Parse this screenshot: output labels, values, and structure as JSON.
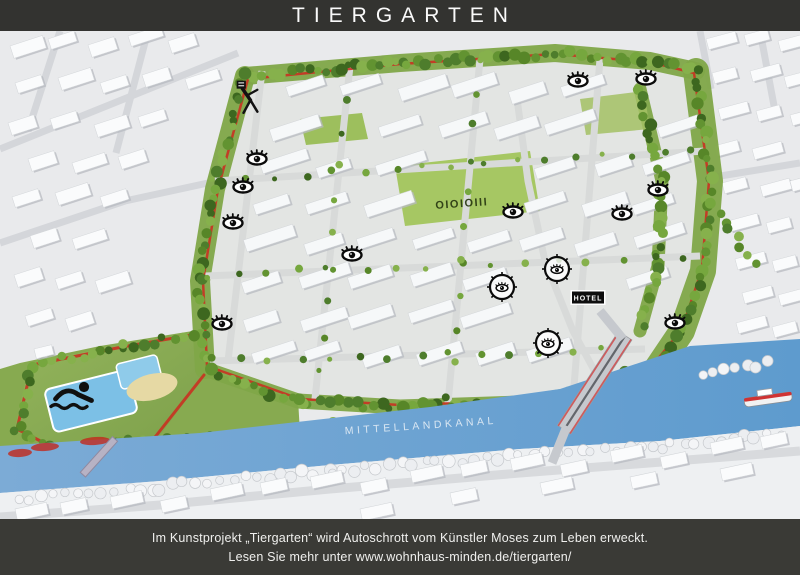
{
  "header": {
    "title": "TIERGARTEN"
  },
  "map": {
    "canal_label": "MITTELLANDKANAL",
    "hotel_label": "HOTEL",
    "lawn_text": "OIOIOIII",
    "colors": {
      "canal_blue": "#6aa3d6",
      "park_green": "#7fa648",
      "track_red": "#cc2a1e",
      "building_white": "#f8fafb",
      "bar_dark": "#333330"
    },
    "markers": {
      "eyes": [
        [
          257,
          128
        ],
        [
          243,
          156
        ],
        [
          233,
          192
        ],
        [
          352,
          224
        ],
        [
          513,
          181
        ],
        [
          578,
          50
        ],
        [
          646,
          48
        ],
        [
          658,
          159
        ],
        [
          622,
          183
        ],
        [
          675,
          292
        ],
        [
          222,
          293
        ]
      ],
      "circled_eyes": [
        [
          557,
          238
        ],
        [
          502,
          256
        ],
        [
          548,
          312
        ]
      ],
      "sculpture": [
        247,
        68
      ],
      "swimmer": [
        72,
        362
      ],
      "hotel": [
        588,
        267
      ],
      "lawn_text_pos": [
        462,
        176
      ],
      "canal_label_pos": [
        421,
        398
      ]
    }
  },
  "footer": {
    "line1": "Im Kunstprojekt „Tiergarten“ wird Autoschrott vom Künstler Moses zum Leben erweckt.",
    "line2_prefix": "Lesen Sie mehr unter",
    "url": "www.wohnhaus-minden.de/tiergarten/"
  }
}
